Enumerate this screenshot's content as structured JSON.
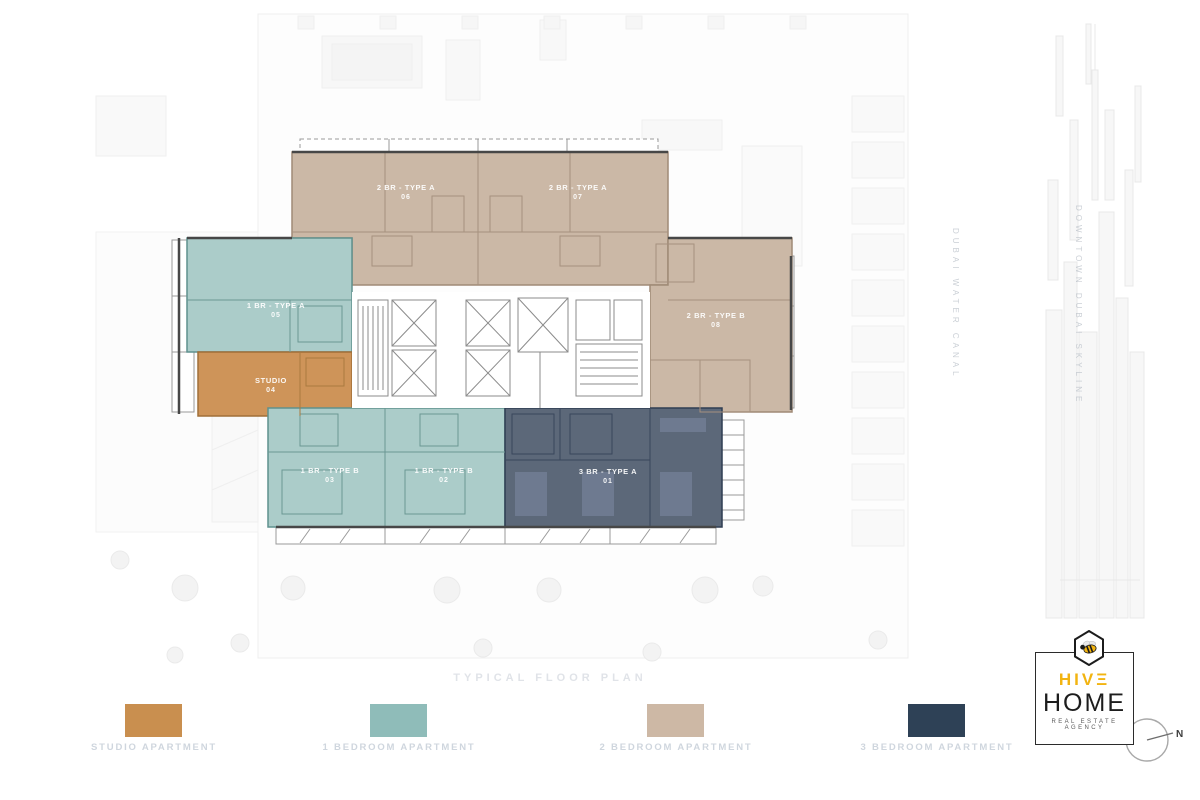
{
  "plan": {
    "caption": "TYPICAL FLOOR PLAN",
    "units": [
      {
        "label": "2 BR - TYPE A",
        "number": "06"
      },
      {
        "label": "2 BR - TYPE A",
        "number": "07"
      },
      {
        "label": "1 BR - TYPE A",
        "number": "05"
      },
      {
        "label": "STUDIO",
        "number": "04"
      },
      {
        "label": "1 BR - TYPE B",
        "number": "03"
      },
      {
        "label": "1 BR - TYPE B",
        "number": "02"
      },
      {
        "label": "3 BR - TYPE A",
        "number": "01"
      },
      {
        "label": "2 BR - TYPE B",
        "number": "08"
      }
    ],
    "context_labels": {
      "canal": "DUBAI WATER CANAL",
      "skyline": "DOWNTOWN DUBAI SKYLINE"
    }
  },
  "legend": {
    "items": [
      {
        "label": "STUDIO APARTMENT",
        "color": "#c98f4f"
      },
      {
        "label": "1 BEDROOM APARTMENT",
        "color": "#8fbcb9"
      },
      {
        "label": "2 BEDROOM APARTMENT",
        "color": "#cdb8a5"
      },
      {
        "label": "3 BEDROOM APARTMENT",
        "color": "#2e4156"
      }
    ]
  },
  "colors": {
    "studio_fill": "#ce9459",
    "one_bed_fill": "#abccc9",
    "two_bed_fill": "#cbb8a6",
    "three_bed_fill": "#5c6879",
    "accent_yellow": "#f2b411"
  },
  "branding": {
    "name_top": "HIVΞ",
    "name_bottom": "HOME",
    "tagline": "REAL ESTATE AGENCY"
  },
  "compass": {
    "north": "N"
  }
}
